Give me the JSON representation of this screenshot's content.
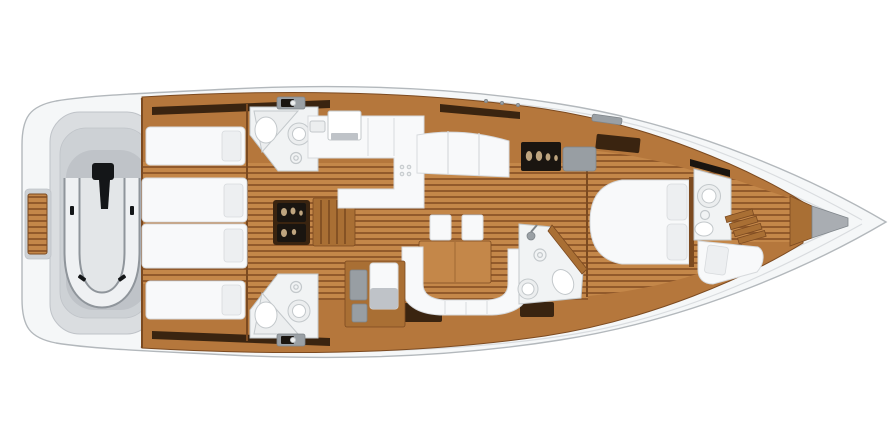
{
  "title": "Sailing yacht interior layout plan — top-down 3D floor plan",
  "colors": {
    "bg": "#ffffff",
    "hull_fill": "#f5f7f8",
    "hull_stroke": "#b3b8bc",
    "deck_line": "#d9dcdf",
    "deck_gray": "#dadde0",
    "deck_gray_mid": "#cdd1d5",
    "deck_gray_deep": "#bfc3c8",
    "teak_light": "#c48749",
    "teak_dark": "#8a5226",
    "wood": "#b5773c",
    "wood_mid": "#a96f34",
    "wood_dark": "#7c4a20",
    "trim_dark": "#3a2410",
    "black": "#1a1510",
    "white_furniture": "#f8f9fa",
    "furniture_stroke": "#d7dadd",
    "pillow": "#edeff1",
    "panel_gray": "#989ea3",
    "hatch_gray": "#9aa0a5",
    "hatch_edge": "#7f858a",
    "dinghy_fill": "#e3e6e8",
    "dinghy_tube": "#eff1f3",
    "dinghy_outline": "#8f959b",
    "motor_black": "#141618",
    "porcelain": "#ffffff",
    "fixture_stroke": "#c3c8cb",
    "shower_floor": "#eceeef",
    "room_floor": "#f1f3f4",
    "glass_glyph": "#bfa57f",
    "anchor_gray": "#a9adb2"
  },
  "areas": {
    "hull": "Hull and deck",
    "swim_platform": "Teak swim platform",
    "dinghy_garage": "Tender garage with inflatable dinghy",
    "dinghy": "Inflatable dinghy with outboard motor",
    "aft_cabin_port": "Aft cabin port side, twin berths",
    "aft_cabin_starboard": "Aft cabin starboard side, twin berths",
    "aft_head_port": "Aft head port side",
    "aft_head_starboard": "Aft head starboard side",
    "engine_compartment": "Engine compartment",
    "companionway": "Companionway stairs",
    "galley": "L-shaped galley",
    "saloon_settee": "Saloon settee",
    "bar_cabinet": "Bar glassware cabinet",
    "chart_panel": "Chart table panel",
    "dining_table": "Saloon dining table",
    "dining_stools": "Dining stools",
    "saloon_sofa": "Curved saloon sofa",
    "nav_station": "Navigation station with chaise",
    "day_head": "Day head with shower",
    "owners_cabin": "Owner's cabin with island double berth",
    "ensuite_head": "En-suite head",
    "forward_locker": "Forward crew cabin and sail locker",
    "anchor_locker": "Anchor locker"
  }
}
